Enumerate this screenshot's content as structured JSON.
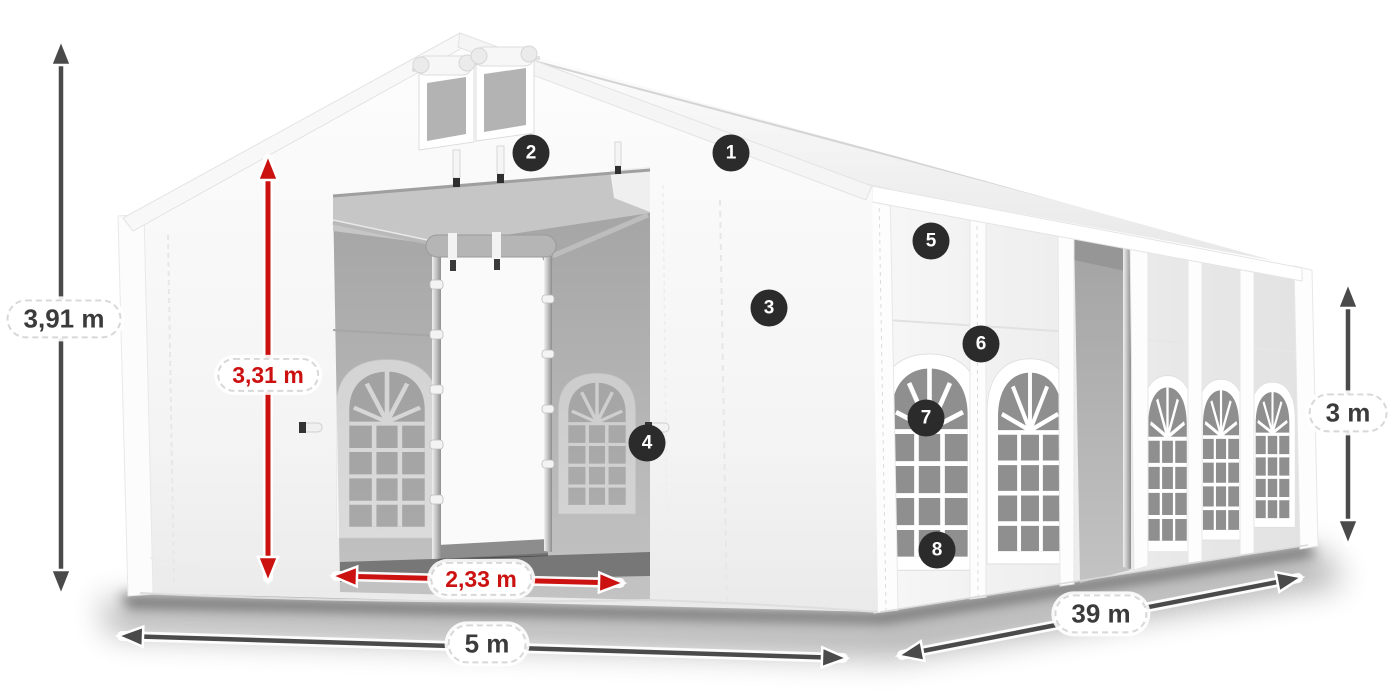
{
  "dimension_labels": {
    "left_vertical": "3,91 m",
    "red_vertical": "3,31 m",
    "red_horizontal": "2,33 m",
    "bottom_front": "5 m",
    "bottom_side": "39 m",
    "right_vertical": "3 m"
  },
  "callouts": [
    "1",
    "2",
    "3",
    "4",
    "5",
    "6",
    "7",
    "8"
  ],
  "colors": {
    "dimension_red": "#cc1111",
    "dimension_gray": "#4a4a4a",
    "label_text": "#3b3b3b",
    "pill_background": "#ffffff",
    "pill_border": "#d8d8d8",
    "badge_background": "#2b2b2b",
    "badge_text": "#ffffff",
    "tent_fabric": "#f5f5f5",
    "tent_interior": "#b4b4b4"
  }
}
